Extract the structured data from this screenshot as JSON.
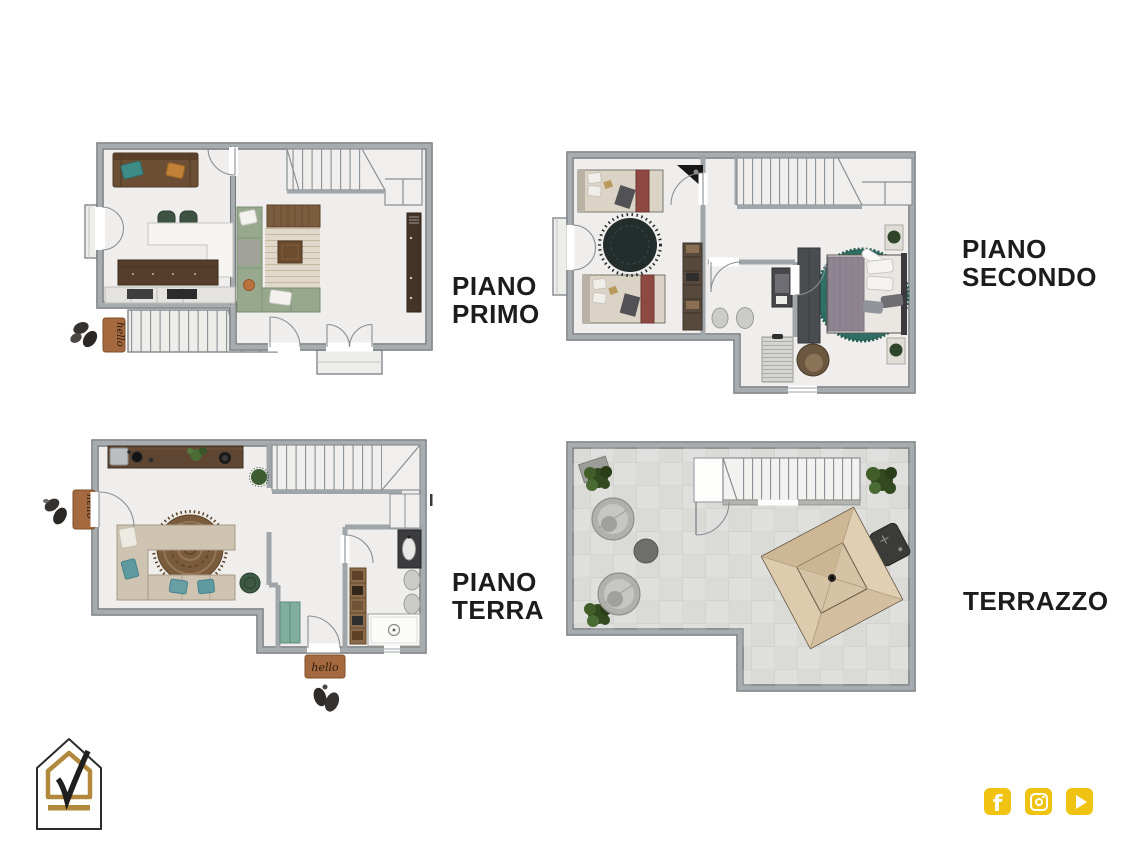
{
  "sheet": {
    "background": "#ffffff"
  },
  "floors": [
    {
      "id": "piano-primo",
      "label_line1": "PIANO",
      "label_line2": "PRIMO"
    },
    {
      "id": "piano-secondo",
      "label_line1": "PIANO",
      "label_line2": "SECONDO"
    },
    {
      "id": "piano-terra",
      "label_line1": "PIANO",
      "label_line2": "TERRA"
    },
    {
      "id": "terrazzo",
      "label_line1": "TERRAZZO",
      "label_line2": ""
    }
  ],
  "doormat": {
    "label": "hello"
  },
  "branding": {
    "logo": "house-check-logo",
    "gold": "#B1883C",
    "outline": "#2B2B2B"
  },
  "social": {
    "color": "#F0C312",
    "items": [
      {
        "name": "facebook-icon",
        "glyph": "f"
      },
      {
        "name": "instagram-icon"
      },
      {
        "name": "youtube-icon"
      }
    ]
  },
  "colors": {
    "wall": "#9FA5A8",
    "wall_edge": "#75797C",
    "floor": "#EFEEEC",
    "terrace_tile": "#DADAD7",
    "label_text": "#1C1C1C",
    "doormat_brown": "#A5693F",
    "rug_teal": "#2F6E64",
    "rug_dark": "#232D2B",
    "rug_boho": "#7A5C3D",
    "sofa_green": "#97A88D",
    "sofa_brown": "#6B4E34",
    "sofa_beige": "#CFC3B2",
    "bed_maroon": "#8E4A42",
    "kitchen_counter": "#5F4632",
    "umbrella_beige": "#D8C5A7",
    "console_teal": "#7FAE9F",
    "bush_green": "#33491F"
  }
}
